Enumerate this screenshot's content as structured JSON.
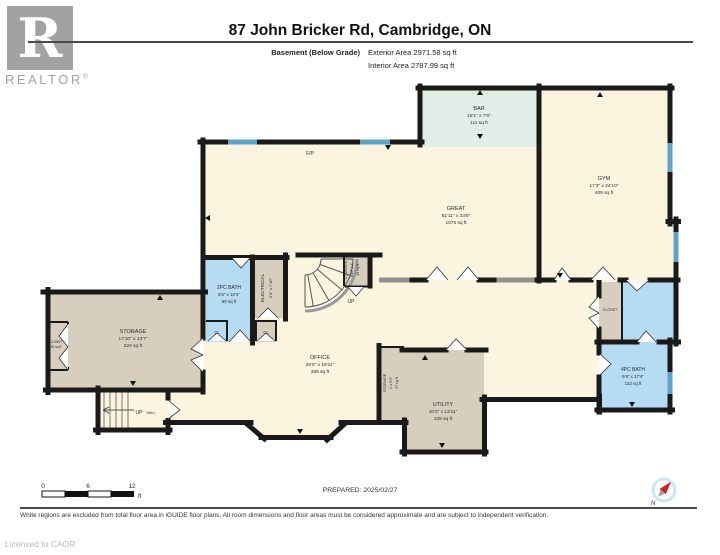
{
  "header": {
    "logo_letter": "R",
    "logo_word": "REALTOR",
    "logo_reg": "®",
    "title": "87 John Bricker Rd, Cambridge, ON",
    "floor_label": "Basement (Below Grade)",
    "exterior_area": "Exterior Area 2971.58 sq ft",
    "interior_area": "Interior Area 2787.99 sq ft"
  },
  "rooms": {
    "bar": {
      "name": "BAR",
      "dims": "15'1\" x 7'6\"",
      "area": "111 sq ft"
    },
    "gym": {
      "name": "GYM",
      "dims": "17'3\" x 24'10\"",
      "area": "409 sq ft"
    },
    "great": {
      "name": "GREAT",
      "dims": "51'11\" x 33'8\"",
      "area": "1075 sq ft"
    },
    "bath2": {
      "name": "2PC BATH",
      "dims": "6'5\" x 10'4\"",
      "area": "59 sq ft"
    },
    "electrical": {
      "name": "ELECTRICAL",
      "dims": "6'4\" x 7'10\""
    },
    "storage_stairs": {
      "name": "STORAGE",
      "dims": "9'10\" x 4'",
      "area": "19 sq ft"
    },
    "storage_main": {
      "name": "STORAGE",
      "dims": "17'10\" x 13'7\"",
      "area": "224 sq ft"
    },
    "closet_left": {
      "name": "CLOSET",
      "area": "20 sq ft"
    },
    "office": {
      "name": "OFFICE",
      "dims": "26'5\" x 18'11\"",
      "area": "355 sq ft"
    },
    "storage_small": {
      "name": "STORAGE",
      "dims": "4' x 9'3\"",
      "area": "37 sq ft"
    },
    "utility": {
      "name": "UTILITY",
      "dims": "10'2\" x 13'11\"",
      "area": "128 sq ft"
    },
    "closet_right": {
      "name": "CLOSET"
    },
    "bath4": {
      "name": "4PC BATH",
      "dims": "9'8\" x 17'4\"",
      "area": "132 sq ft"
    }
  },
  "labels": {
    "fireplace": "F/P",
    "stairs_up": "UP",
    "hall_up": "UP",
    "hall_hall": "HALL",
    "cl1": "CL",
    "cl2": "CL",
    "north": "N"
  },
  "scale_bar": {
    "start": "0",
    "mid": "6",
    "end": "12",
    "unit": "ft"
  },
  "footer": {
    "prepared": "PREPARED: 2025/02/27",
    "disclaimer": "White regions are excluded from total floor area in iGUIDE floor plans. All room dimensions and floor areas must be considered approximate and are subject to independent verification.",
    "license": "Licensed to CAOR"
  },
  "colors": {
    "wall": "#1a1a1a",
    "floor_cream": "#fbf4de",
    "room_tan": "#d8cebe",
    "bath_blue": "#b5dcf2",
    "bar_teal": "#e0eee7",
    "window_blue": "#5ea4c8",
    "railing_grey": "#909090",
    "logo_grey": "#a2a2a2"
  }
}
